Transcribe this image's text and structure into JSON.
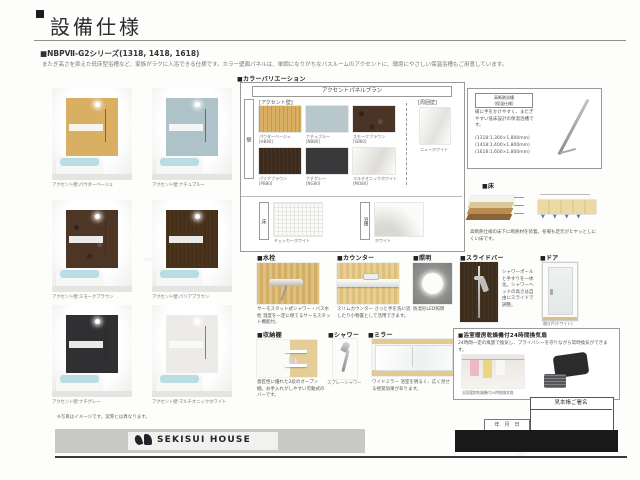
{
  "page": {
    "title": "設備仕様",
    "series_heading": "■NBPⅦ-G2シリーズ(1318, 1418, 1618)",
    "series_description": "またぎ高さを抑えた低床型浴槽など、家族がラクに入浴できる仕様です。カラー壁面パネルは、単調になりがちなバスルームのアクセントに、環境にやさしい保温浴槽もご用意しています。",
    "footnote": "※写真はイメージです。実際とは異なります。",
    "brand": "SEKISUI HOUSE"
  },
  "gallery": {
    "items": [
      {
        "caption": "アクセント壁:パウダーベージュ",
        "color": "#d9af63"
      },
      {
        "caption": "アクセント壁:ナチュブルー",
        "color": "#aec2c9"
      },
      {
        "caption": "アクセント壁:スモークブラウン",
        "color": "#4e3627"
      },
      {
        "caption": "アクセント壁:パリアブラウン",
        "color": "#44301f"
      },
      {
        "caption": "アクセント壁:ナチグレー",
        "color": "#303032"
      },
      {
        "caption": "アクセント壁:マルチオニックホワイト",
        "color": "#edebe7"
      }
    ]
  },
  "color_variation": {
    "heading": "■カラーバリエーション",
    "plan_header": "アクセントパネルプラン",
    "wall_vertical_label": "壁",
    "accent_label": "[アクセント壁]",
    "surround_label": "[周囲壁]",
    "surround_name": "ニューホワイト",
    "surround_color": "#f4f4f2",
    "swatches": [
      {
        "name": "パウダーベージュ",
        "code": "[HB80]",
        "color": "#d9af63"
      },
      {
        "name": "ナチュブルー",
        "code": "[NB80]",
        "color": "#b7c7cb"
      },
      {
        "name": "スモークブラウン",
        "code": "[SB80]",
        "color": "#4a3425"
      },
      {
        "name": "パリアブラウン",
        "code": "[PB80]",
        "color": "#3c2b1d"
      },
      {
        "name": "ナチグレー",
        "code": "[NG80]",
        "color": "#39393b"
      },
      {
        "name": "マルチオニックホワイト",
        "code": "[MO80]",
        "color": "#eae8e4"
      }
    ],
    "floor": {
      "vertical_label": "床",
      "name": "チェッカーホワイト"
    },
    "bathtub": {
      "vertical_label": "浴槽",
      "name": "ホワイト"
    }
  },
  "tub_info": {
    "badge_line1": "高断熱浴槽",
    "badge_line2": "(保温仕様)",
    "description": "縁に手をかけやすく、またぎやすい低床設計の保温浴槽です。",
    "sizes": [
      "(1318:1,300×1,800mm)",
      "(1418:1,400×1,800mm)",
      "(1618:1,600×1,800mm)"
    ]
  },
  "sections": {
    "floor": {
      "label": "■床",
      "description": "高断熱仕様の床下に断熱材を装着。冬場も足元がヒヤッとしにくい床です。"
    },
    "faucet": {
      "label": "■水栓",
      "title": "サーモスタット式シャワー・バス水栓",
      "description": "温度を一定に保てるサーモスタット機能付。"
    },
    "counter": {
      "label": "■カウンター",
      "title": "スリムカウンター",
      "description": "さっと手を洗い流したり小物置として活用できます。"
    },
    "light": {
      "label": "■照明",
      "caption": "防湿形LED照明"
    },
    "slidebar": {
      "label": "■スライドバー",
      "description": "シャワーポールと手すりを一体化。シャワーヘッドの高さは自由にスライドで調整。"
    },
    "door": {
      "label": "■ドア",
      "caption": "開き戸(ホワイト)"
    },
    "shelf": {
      "label": "■収納棚",
      "description": "意匠性に優れた2段のオープン棚。お手入れがしやすい可動式のバーです。"
    },
    "shower": {
      "label": "■シャワー",
      "caption": "スプレーシャワー"
    },
    "mirror": {
      "label": "■ミラー",
      "title": "ワイドミラー",
      "description": "浴室を明るく、広く見せる視覚効果があります。"
    },
    "ventilation": {
      "label": "■浴室暖房乾燥機付24時間換気扇",
      "description": "24時間一定の風量で換気し、プライバシーを守りながら常時換気ができます。",
      "photo_caption": "浴室暖房乾燥機付24時間換気扇"
    }
  },
  "signature": {
    "header": "見本帳ご署名",
    "date_label": "年　月　日"
  }
}
